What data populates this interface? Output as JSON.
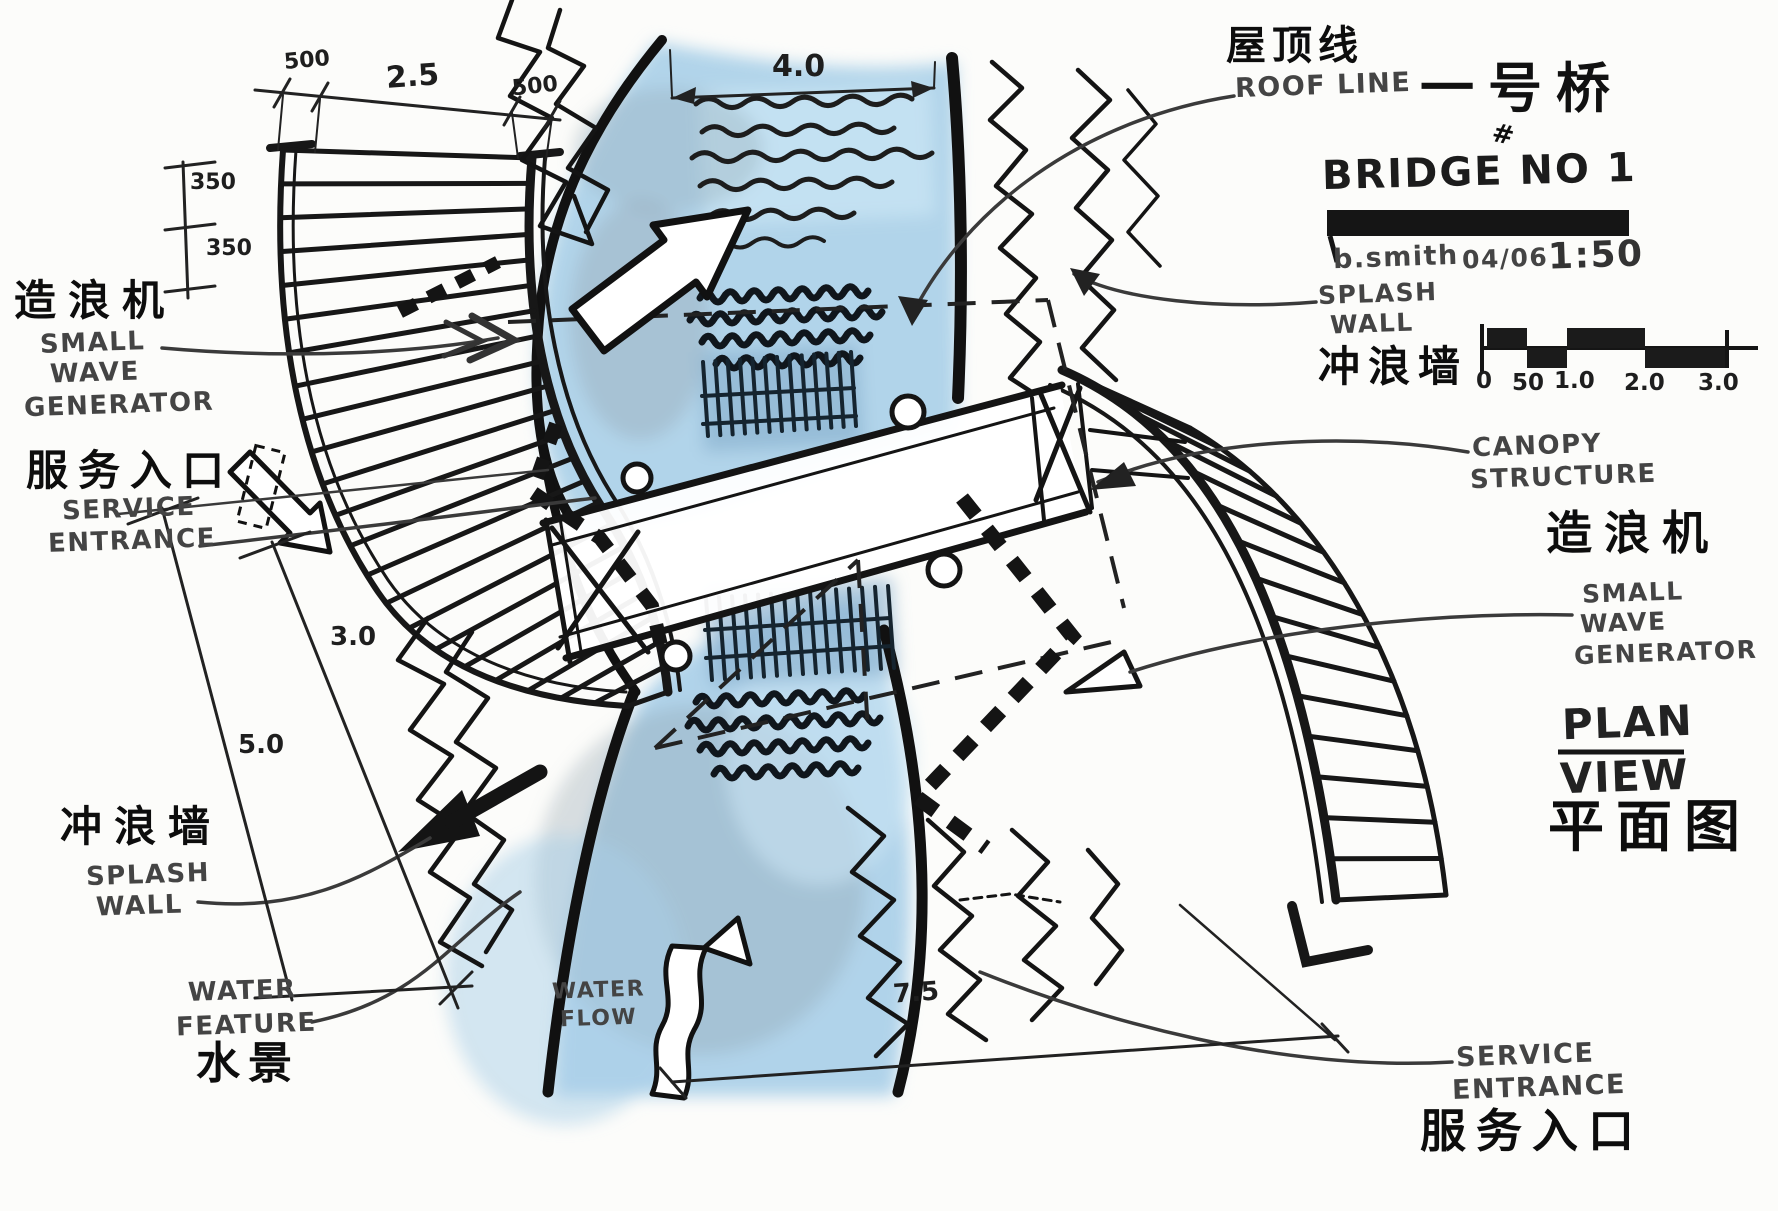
{
  "title_block": {
    "title_cn": "一号桥",
    "number_mark": "#",
    "title_en": "BRIDGE NO 1",
    "author": "b.smith",
    "date": "04/06",
    "scale": "1:50",
    "scale_bar": [
      "0",
      "50",
      "1.0",
      "2.0",
      "3.0"
    ]
  },
  "annotations": {
    "roof_line": {
      "cn": "屋顶线",
      "en": "ROOF LINE"
    },
    "splash_wall_right": {
      "lines": [
        "SPLASH",
        "WALL"
      ],
      "cn": "冲浪墙"
    },
    "canopy": {
      "lines": [
        "CANOPY",
        "STRUCTURE"
      ]
    },
    "wave_generator_right": {
      "cn": "造浪机",
      "lines": [
        "SMALL",
        "WAVE",
        "GENERATOR"
      ]
    },
    "plan_view": {
      "lines": [
        "PLAN",
        "VIEW"
      ],
      "cn": "平面图"
    },
    "wave_generator_left": {
      "cn": "造浪机",
      "lines": [
        "SMALL",
        "WAVE",
        "GENERATOR"
      ]
    },
    "service_entrance_left": {
      "cn": "服务入口",
      "lines": [
        "SERVICE",
        "ENTRANCE"
      ]
    },
    "splash_wall_left": {
      "cn": "冲浪墙",
      "lines": [
        "SPLASH",
        "WALL"
      ]
    },
    "water_feature": {
      "lines": [
        "WATER",
        "FEATURE"
      ],
      "cn": "水景"
    },
    "water_flow": {
      "lines": [
        "WATER",
        "FLOW"
      ]
    },
    "service_entrance_right": {
      "lines": [
        "SERVICE",
        "ENTRANCE"
      ],
      "cn": "服务入口"
    }
  },
  "dimensions": {
    "d500a": "500",
    "d25": "2.5",
    "d500b": "500",
    "d350a": "350",
    "d350b": "350",
    "d40": "4.0",
    "d30": "3.0",
    "d50": "5.0",
    "d75": "7.5"
  },
  "colors": {
    "ink": "#141414",
    "water": "#a9cfe8",
    "water_light": "#c9e5f4",
    "wash_gray": "#95a3ac"
  }
}
